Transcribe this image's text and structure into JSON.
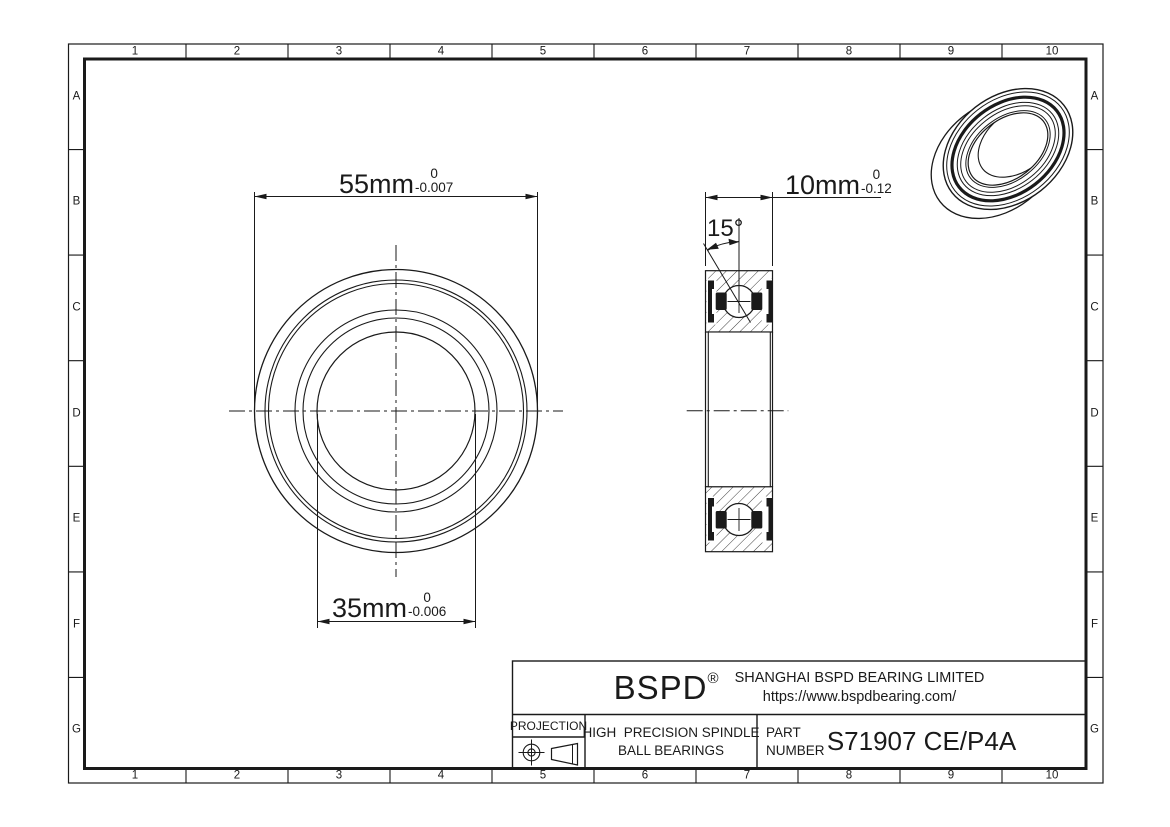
{
  "canvas": {
    "background": "#ffffff",
    "ink_color": "#1a1a1a"
  },
  "grid": {
    "columns": [
      "1",
      "2",
      "3",
      "4",
      "5",
      "6",
      "7",
      "8",
      "9",
      "10"
    ],
    "rows": [
      "A",
      "B",
      "C",
      "D",
      "E",
      "F",
      "G"
    ]
  },
  "front_view": {
    "outer_dim": {
      "value": "55mm",
      "tol_upper": "0",
      "tol_lower": "-0.007"
    },
    "bore_dim": {
      "value": "35mm",
      "tol_upper": "0",
      "tol_lower": "-0.006"
    }
  },
  "section_view": {
    "width_dim": {
      "value": "10mm",
      "tol_upper": "0",
      "tol_lower": "-0.12"
    },
    "contact_angle": "15°"
  },
  "title_block": {
    "brand": "BSPD",
    "reg_mark": "®",
    "company": "SHANGHAI BSPD BEARING LIMITED",
    "website": "https://www.bspdbearing.com/",
    "projection_label": "PROJECTION",
    "product_line1": "HIGH  PRECISION SPINDLE",
    "product_line2": "BALL BEARINGS",
    "part_label1": "PART",
    "part_label2": "NUMBER",
    "part_number": "S71907 CE/P4A"
  }
}
